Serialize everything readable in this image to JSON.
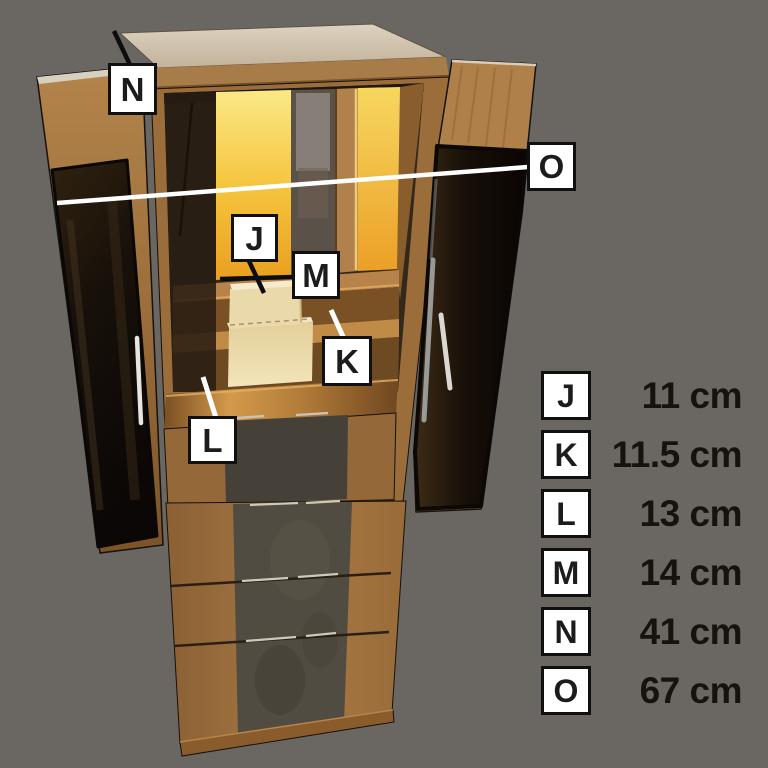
{
  "colors": {
    "background": "#6a6662",
    "label_background": "#ffffff",
    "label_border": "#101010",
    "label_text": "#1c1c1c",
    "value_text": "#16120e",
    "dark_line": "#0d0d0d",
    "light_line": "#ffffff",
    "glow": "#f3bb35"
  },
  "callouts": [
    {
      "letter": "J"
    },
    {
      "letter": "K"
    },
    {
      "letter": "L"
    },
    {
      "letter": "M"
    },
    {
      "letter": "N"
    },
    {
      "letter": "O"
    }
  ],
  "legend": {
    "rows": [
      {
        "letter": "J",
        "value": "11 cm"
      },
      {
        "letter": "K",
        "value": "11.5 cm"
      },
      {
        "letter": "L",
        "value": "13 cm"
      },
      {
        "letter": "M",
        "value": "14 cm"
      },
      {
        "letter": "N",
        "value": "41 cm"
      },
      {
        "letter": "O",
        "value": "67 cm"
      }
    ]
  }
}
